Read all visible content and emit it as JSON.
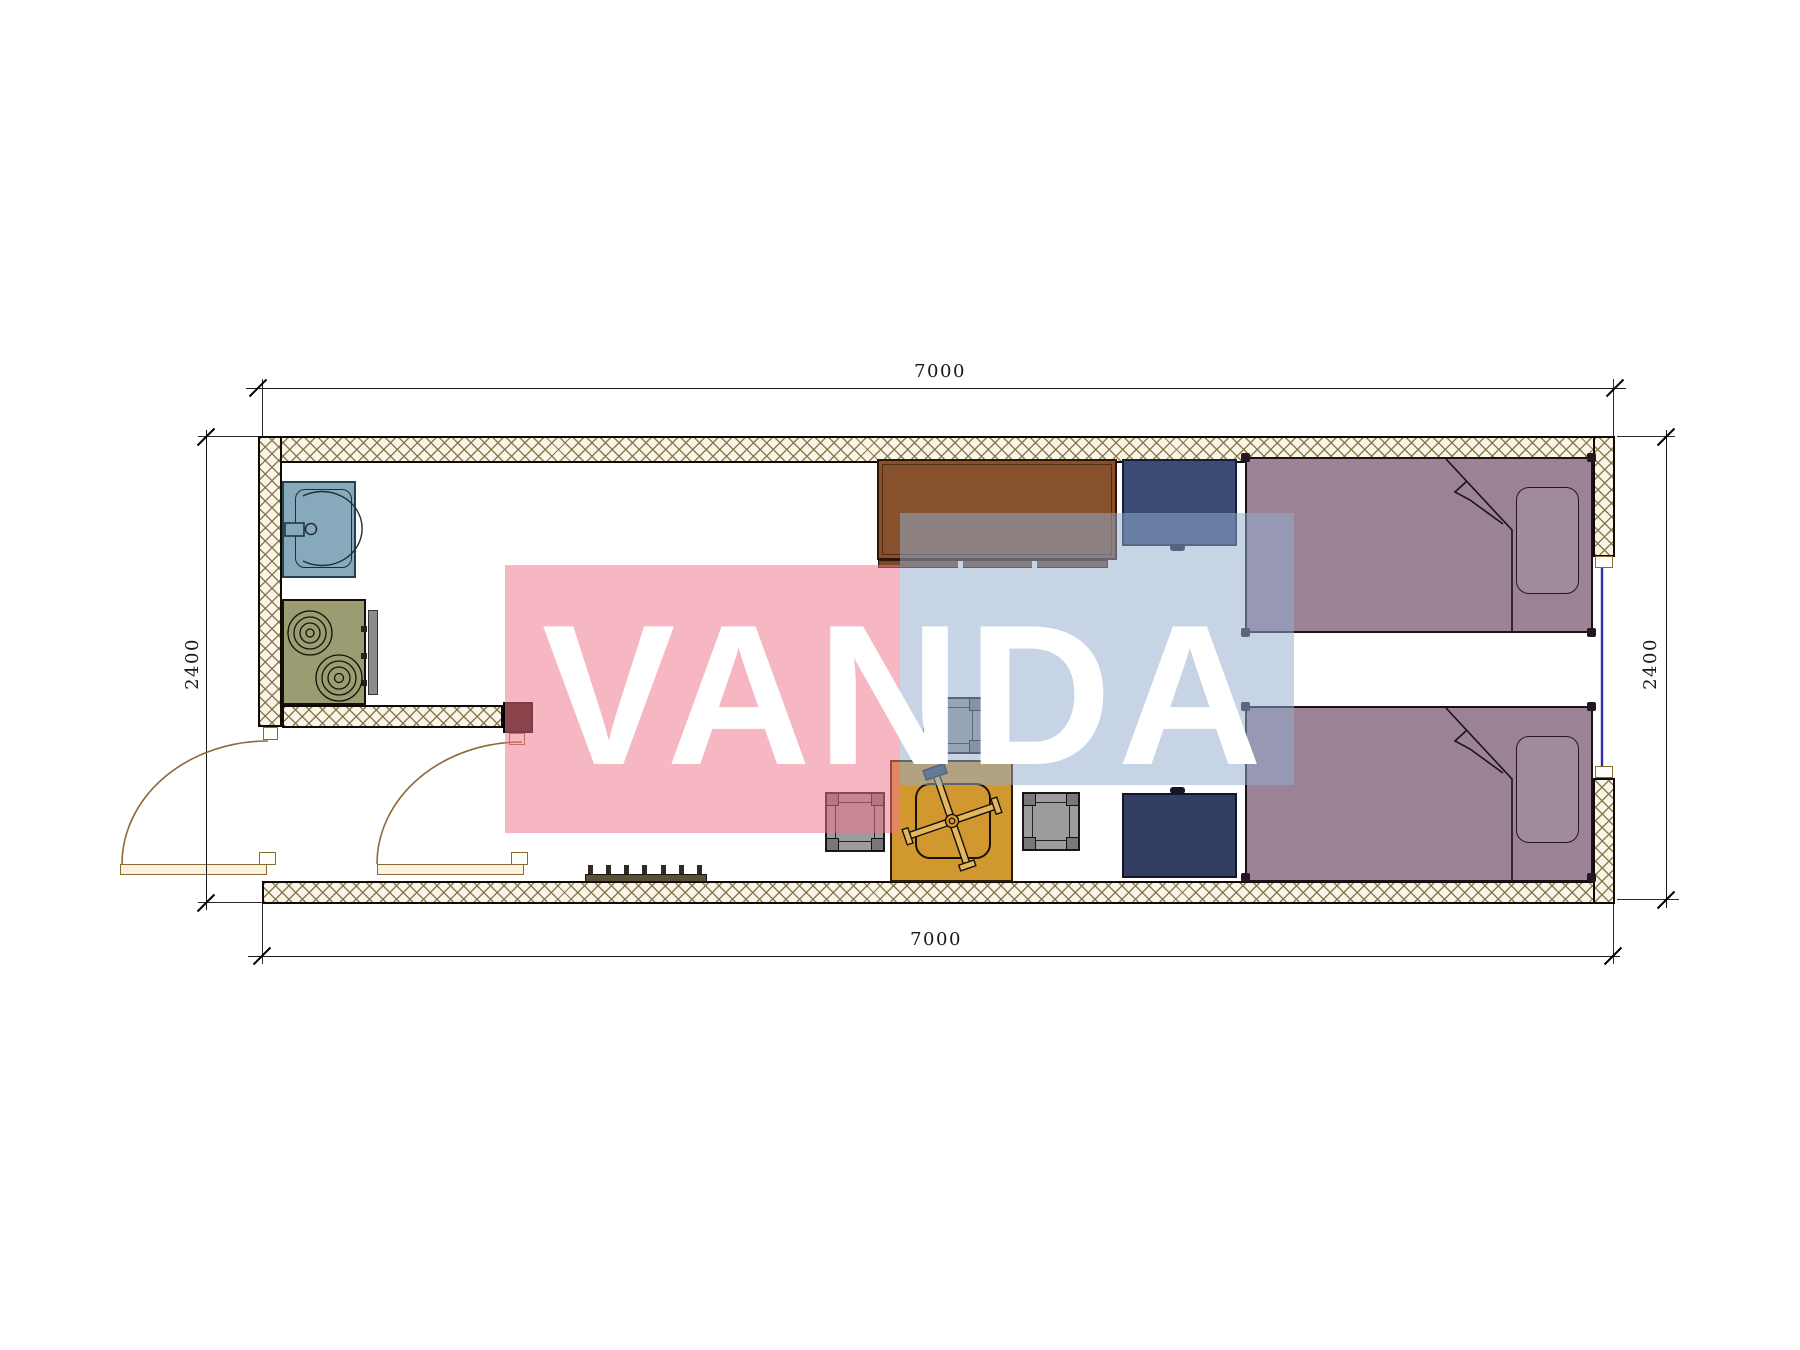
{
  "page": {
    "type": "architectural-floor-plan",
    "width_px": 1800,
    "height_px": 1350
  },
  "dimensions": {
    "top": {
      "label": "7000"
    },
    "bottom": {
      "label": "7000"
    },
    "left": {
      "label": "2400"
    },
    "right": {
      "label": "2400"
    }
  },
  "watermark": {
    "text": "VANDA",
    "pink_color": "#F0758B",
    "blue_color": "#93ADCF",
    "text_color": "#FFFFFF"
  },
  "plan": {
    "colors": {
      "wall_hatch_line": "#85754A",
      "wall_fill": "#FAF5E7",
      "wall_border": "#0F0A04",
      "sink": "#86AABC",
      "stove": "#9C9C72",
      "desk": "#86512C",
      "cabinet_navy": "#3B4C74",
      "nightstand_navy": "#343E63",
      "bed_mauve": "#9B8294",
      "table_orange": "#D1982F",
      "stool_gray": "#9C9C9C",
      "bench_brown": "#5A4F38",
      "door_tan": "#8A6A35",
      "window_glass_blue": "#2E2EA8",
      "dimension_ink": "#1A1A1A"
    },
    "glyphs": [
      "sink",
      "stove",
      "kitchen-counter-desk",
      "wardrobe",
      "bed",
      "bed",
      "nightstand",
      "folding-table-with-cross-base",
      "stool",
      "stool",
      "stool",
      "entry-bench",
      "swing-door",
      "swing-door",
      "window"
    ]
  }
}
